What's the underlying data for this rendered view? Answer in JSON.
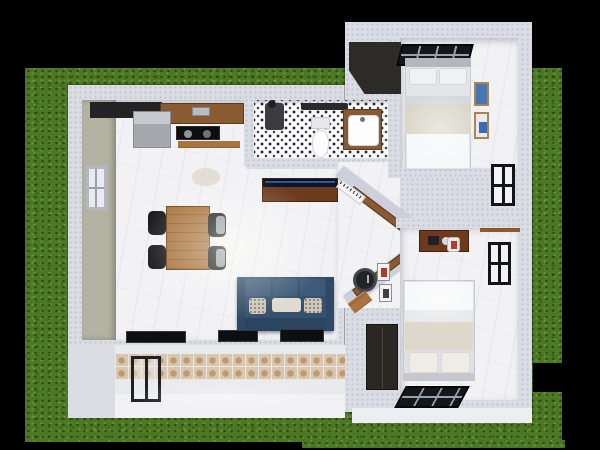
{
  "scene": {
    "type": "3d-top-down-floorplan-render",
    "palette": {
      "bg": "#000000",
      "grass": "#4c7724",
      "wall": "#dbdde5",
      "floor": "#f2f2f5",
      "porchtile": "#d7c7b0",
      "wood-dark": "#6e3a1d",
      "wood-mid": "#8a5a33",
      "wood-light": "#a9743f",
      "sofa": "#35516d",
      "accent-blue": "#2458a8",
      "fixture-dark": "#141416",
      "olive-wall": "#b3b2a3"
    },
    "rooms": [
      {
        "name": "kitchen",
        "furniture": [
          "refrigerator",
          "counter",
          "cooktop",
          "shelf"
        ]
      },
      {
        "name": "bathroom",
        "furniture": [
          "toilet",
          "vanity-sink",
          "shower-mixer",
          "towel-bar"
        ]
      },
      {
        "name": "living-dining",
        "furniture": [
          "dining-table",
          "four-chairs",
          "blue-sofa",
          "throw-pillows",
          "tv-console",
          "south-windows",
          "rug"
        ]
      },
      {
        "name": "bedroom-1",
        "furniture": [
          "double-bed",
          "skylight-grid",
          "wall-art-x2",
          "side-window",
          "dark-roof-wedge"
        ]
      },
      {
        "name": "bedroom-2",
        "furniture": [
          "double-bed",
          "desk",
          "desk-chair",
          "wardrobe",
          "skylight-grid",
          "side-window",
          "shelf"
        ]
      },
      {
        "name": "hallway",
        "furniture": [
          "angled-walls",
          "wood-consoles",
          "wall-clock",
          "small-frames",
          "stool",
          "radiator"
        ]
      },
      {
        "name": "porch",
        "furniture": [
          "glass-door",
          "mosaic-wainscot",
          "walkway-slab"
        ]
      }
    ]
  }
}
